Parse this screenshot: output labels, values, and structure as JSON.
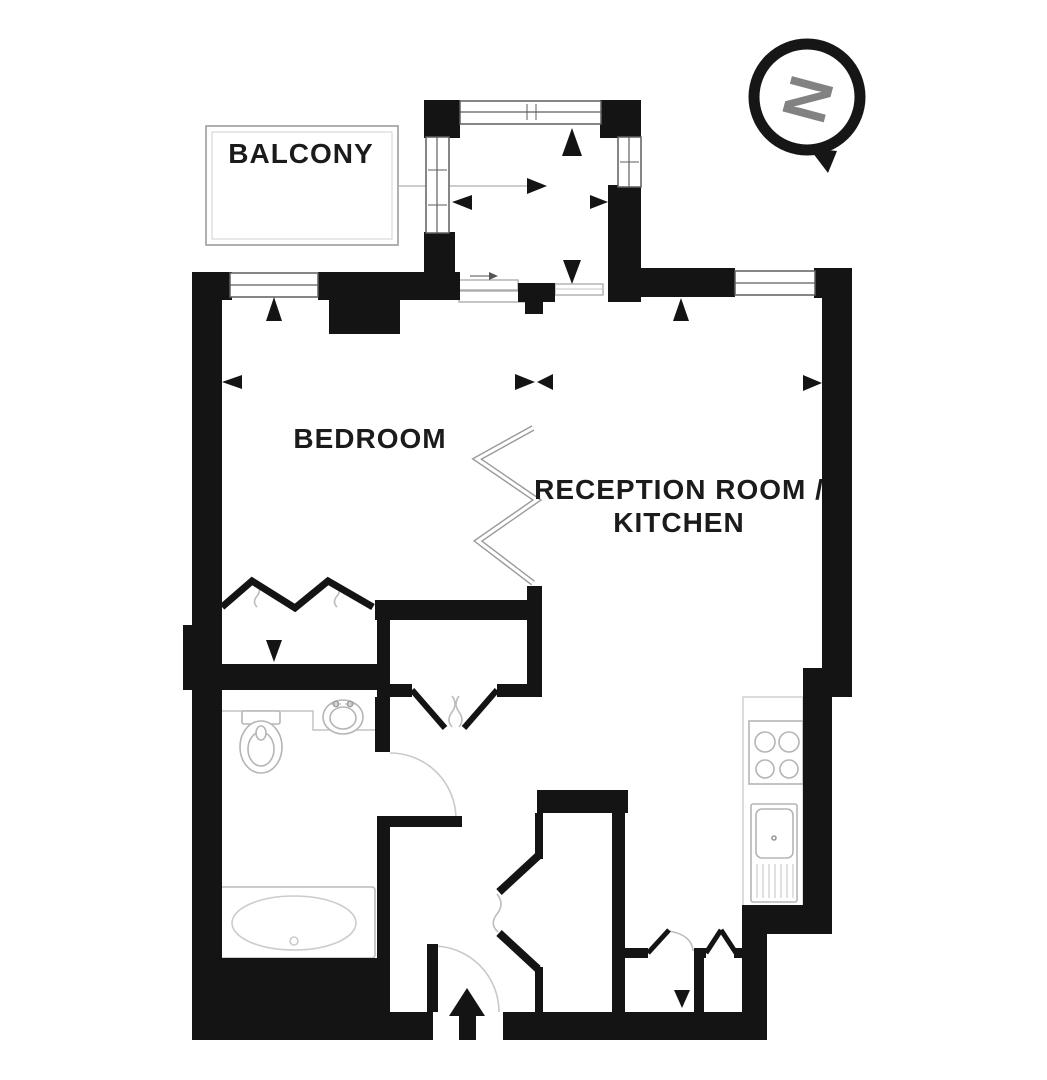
{
  "labels": {
    "balcony": "BALCONY",
    "bedroom": "BEDROOM",
    "reception_line_1": "RECEPTION ROOM /",
    "reception_line_2": "KITCHEN",
    "compass_north": "N"
  },
  "colors": {
    "background": "#ffffff",
    "wall": "#141414",
    "thin_line": "#a8a8a8",
    "fixture_line": "#b9b9b9",
    "label_text": "#1b1b1b",
    "compass_letter": "#828282"
  },
  "icons": {
    "compass": "north-compass",
    "entrance": "entrance-arrow",
    "fixtures": [
      "toilet-icon",
      "washbasin-icon",
      "bathtub-icon",
      "hob-icon",
      "kitchen-sink-icon"
    ]
  }
}
